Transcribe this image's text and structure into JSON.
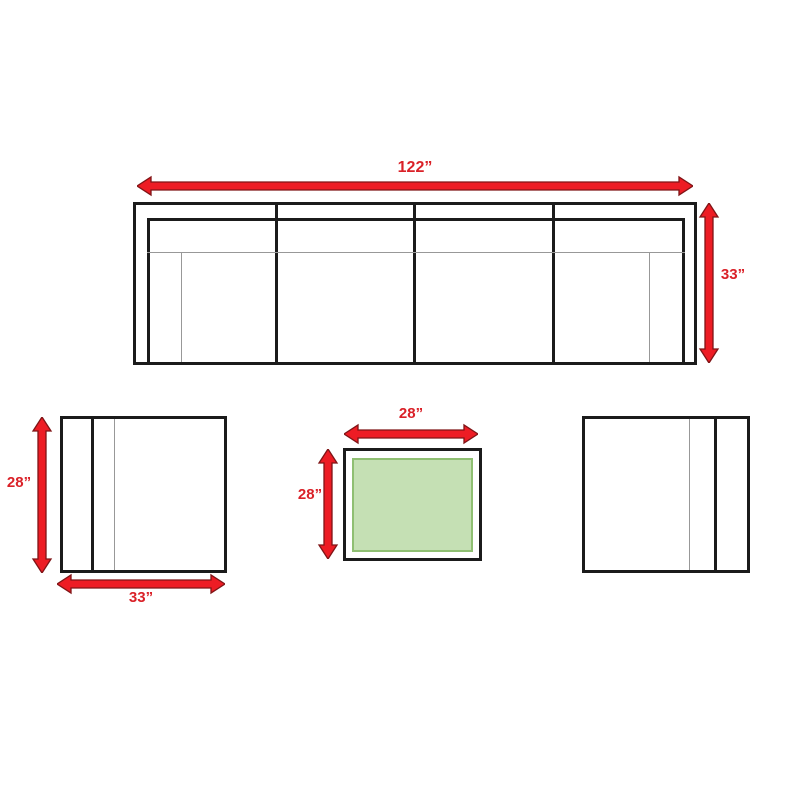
{
  "pieces": {
    "sofa": {
      "width": "122”",
      "depth": "33”"
    },
    "chair": {
      "depth": "28”",
      "width": "33”"
    },
    "coffee_table": {
      "width": "28”",
      "depth": "28”"
    }
  },
  "colors": {
    "arrow_red": "#ed1c24",
    "arrow_outline": "#7f1416",
    "label_red": "#da2128",
    "table_green_fill": "#c5e0b4",
    "table_green_border": "#8fbf72",
    "line_black": "#1b1b1b",
    "line_gray": "#989898"
  }
}
